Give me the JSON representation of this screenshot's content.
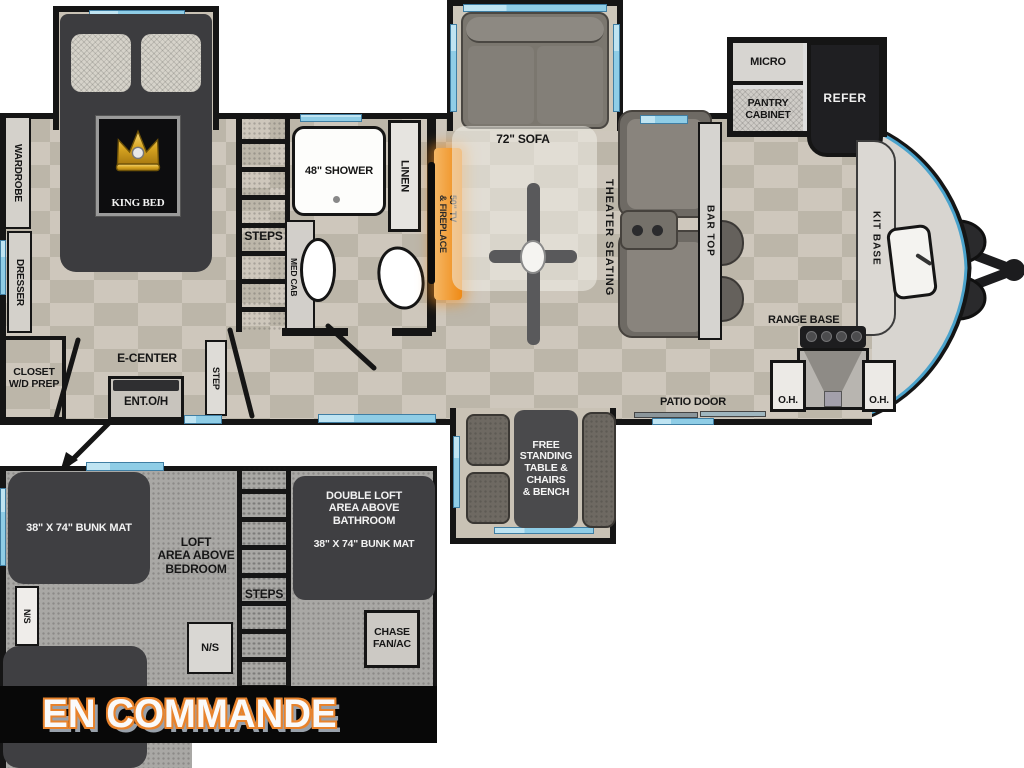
{
  "banner": {
    "label": "EN COMMANDE"
  },
  "colors": {
    "wall": "#151515",
    "window_blue": "#8fcde6",
    "accent_orange": "#ef8a15",
    "floor_tan": "#c8c1b4",
    "loft_gray": "#a9a8a5",
    "furniture_dark": "#3f3f42",
    "banner_bg": "#080808",
    "banner_text": "#fafafa"
  },
  "main": {
    "wardrobe": "WARDROBE",
    "dresser": "DRESSER",
    "king_bed": "KING BED",
    "closet": "CLOSET\nW/D PREP",
    "steps": "STEPS",
    "step": "STEP",
    "e_center": "E-CENTER",
    "ent_oh": "ENT.O/H",
    "med_cab": "MED CAB",
    "shower": "48\" SHOWER",
    "linen": "LINEN",
    "tv_fireplace": "50\" TV\n& FIREPLACE",
    "sofa": "72\" SOFA",
    "theater": "THEATER SEATING",
    "bar_top": "BAR TOP",
    "micro": "MICRO",
    "pantry": "PANTRY\nCABINET",
    "refer": "REFER",
    "kit_base": "KIT BASE",
    "range_base": "RANGE BASE",
    "oh_left": "O.H.",
    "oh_right": "O.H.",
    "patio_door": "PATIO DOOR",
    "dinette": "FREE\nSTANDING\nTABLE &\nCHAIRS\n& BENCH"
  },
  "loft": {
    "bunk_mat_top": "38\" X 74\" BUNK MAT",
    "loft_area": "LOFT\nAREA ABOVE\nBEDROOM",
    "ns_left": "N/S",
    "ns_box": "N/S",
    "steps": "STEPS",
    "double_loft": "DOUBLE LOFT\nAREA ABOVE\nBATHROOM",
    "double_loft_mat": "38\" X 74\" BUNK MAT",
    "chase": "CHASE\nFAN/AC"
  }
}
